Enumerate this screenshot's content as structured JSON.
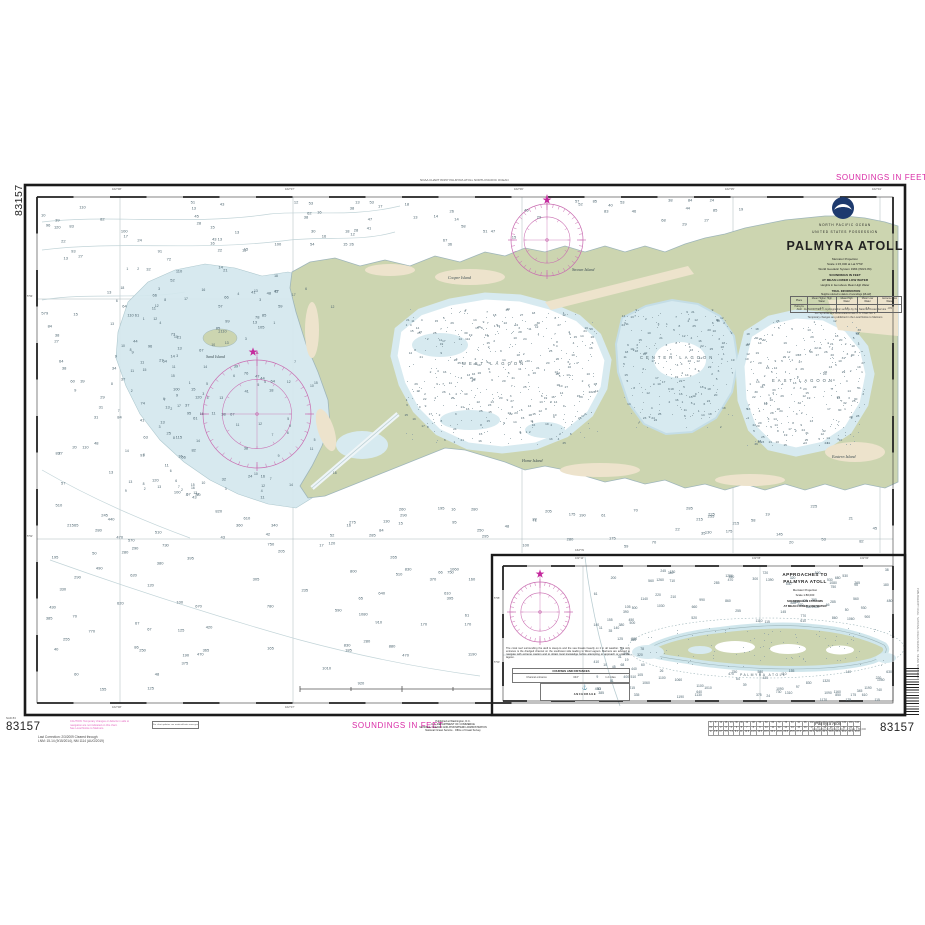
{
  "chart": {
    "number": "83157",
    "soundings_top": "SOUNDINGS IN FEET",
    "soundings_bottom": "SOUNDINGS IN FEET",
    "top_margin_note": "NOAA CHART 83157  PALMYRA ATOLL  NORTH PACIFIC OCEAN",
    "side_print_note": "PUBLISHED BY NOAA · NATIONAL OCEAN SERVICE · SILVER SPRING MD"
  },
  "title_block": {
    "region": "NORTH PACIFIC OCEAN",
    "possession": "UNITED STATES POSSESSION",
    "title": "PALMYRA ATOLL",
    "projection": "Mercator Projection",
    "scale_line": "Scale 1:15,000 at Lat 5°53'",
    "datum_line": "World Geodetic System 1984 (WGS 84)",
    "soundings1": "SOUNDINGS IN FEET",
    "soundings2": "AT MEAN LOWER LOW WATER",
    "heights_line": "Heights in feet above Mean High Water",
    "auth1": "AUTHORITIES — Hydrographic surveys by the National Ocean Service",
    "auth2": "For Symbols and Abbreviations see U.S. Chart No. 1",
    "auth3": "Temporary changes are published in the Local Notice to Mariners"
  },
  "tidal_table": {
    "title": "TIDAL INFORMATION",
    "subtitle": "Heights referred to datum of soundings (MLLW)",
    "columns": [
      "Place",
      "Mean Higher High Water",
      "Mean High Water",
      "Mean Low Water",
      "Extreme Low Water"
    ],
    "row": [
      "Palmyra Atoll",
      "1.6",
      "1.4",
      "0.3",
      "-0.5"
    ]
  },
  "labels": {
    "west_lagoon": "WEST LAGOON",
    "center_lagoon": "CENTER LAGOON",
    "east_lagoon": "EAST LAGOON",
    "islands": [
      {
        "name": "Sand Island"
      },
      {
        "name": "Cooper Island"
      },
      {
        "name": "Strawn Island"
      },
      {
        "name": "Home Island"
      },
      {
        "name": "Eastern Island"
      }
    ]
  },
  "graticule": {
    "main_top": [
      "162°08'",
      "162°07'",
      "162°06'",
      "162°05'",
      "162°04'"
    ],
    "main_bottom": [
      "162°08'",
      "162°07'"
    ],
    "main_left": [
      "5°54'",
      "5°52'"
    ],
    "inset_top": [
      "162°10'",
      "162°05'",
      "162°00'"
    ],
    "inset_left": [
      "5°55'",
      "5°50'"
    ],
    "inset_top_outer": "162°W"
  },
  "inset": {
    "title1": "APPROACHES TO",
    "title2": "PALMYRA ATOLL",
    "projection": "Mercator Projection",
    "scale": "Scale 1:80,000",
    "soundings1": "SOUNDINGS IN FATHOMS",
    "soundings2": "AT MEAN LOWER LOW WATER",
    "atoll_label": "PALMYRA ATOLL",
    "note_lines": [
      "The coral reef surrounding the atoll is steep-to and the",
      "sea breaks heavily on it in all weather. The only entrance",
      "is the dredged channel on the southwest side leading to",
      "West Lagoon. Mariners are advised to navigate with",
      "extreme caution and to obtain local knowledge before",
      "attempting to approach or enter the lagoon."
    ],
    "table_header": "COURSES AND DISTANCES",
    "table_cells": [
      "Channel entrance",
      "044°",
      "1.2 miles"
    ],
    "diagram_label": "ANCHORAGE",
    "anchor_glyph": "⚓"
  },
  "footer": {
    "number_left": "83157",
    "number_right": "83157",
    "nad_note": "NAD 83",
    "correction1": "Last Correction: 2/3/2009   Cleared through",
    "correction2": "LNM: 15-14 (9/15/2014), NM 1114 (AUG/2019)",
    "caution1": "CAUTION: Temporary changes or defects in aids to",
    "caution2": "navigation are not indicated on this chart.",
    "caution3": "See Local Notice to Mariners.",
    "box_note": "For chart updates see nauticalcharts.noaa.gov",
    "publisher1": "Published at Washington, D.C.",
    "publisher2": "U.S. DEPARTMENT OF COMMERCE",
    "publisher3": "NATIONAL OCEANIC AND ATMOSPHERIC ADMINISTRATION",
    "publisher4": "National Ocean Service · Office of Coast Survey",
    "inset_ref_title": "Palmyra Atoll",
    "inset_ref_sub": "Approaches to Palmyra Atoll — Scale 1:80,000"
  },
  "depth_conversion": {
    "row_labels": [
      "ft",
      "fm",
      "m"
    ],
    "feet": [
      6,
      12,
      18,
      24,
      30,
      36,
      42,
      48,
      54,
      60,
      66,
      72,
      78,
      84,
      90,
      96,
      102,
      108,
      114,
      120,
      126,
      132,
      138,
      144
    ],
    "fathoms": [
      1,
      2,
      3,
      4,
      5,
      6,
      7,
      8,
      9,
      10,
      11,
      12,
      13,
      14,
      15,
      16,
      17,
      18,
      19,
      20,
      21,
      22,
      23,
      24
    ],
    "meters": [
      1.8,
      3.7,
      5.5,
      7.3,
      9.1,
      11,
      12.8,
      14.6,
      16.5,
      18.3,
      20.1,
      21.9,
      23.8,
      25.6,
      27.4,
      29.3,
      31.1,
      32.9,
      34.7,
      36.6,
      38.4,
      40.2,
      42.1,
      43.9
    ]
  },
  "colors": {
    "magenta_text": "#d92ba6",
    "compass": "#c96bb0",
    "star": "#c4299d",
    "land_green": "#ccd5b0",
    "sand_tan": "#ede3cc",
    "shallow_blue": "#d4e8ee",
    "neatline": "#1a1a1a"
  },
  "compass_roses": [
    {
      "cx": 547,
      "cy": 240,
      "r": 36
    },
    {
      "cx": 257,
      "cy": 414,
      "r": 54
    },
    {
      "cx": 540,
      "cy": 612,
      "r": 30
    }
  ],
  "stars": [
    {
      "x": 547,
      "y": 200
    },
    {
      "x": 253,
      "y": 352
    },
    {
      "x": 540,
      "y": 574
    }
  ],
  "ticks": {
    "main": {
      "x0": 37,
      "y0": 197,
      "x1": 893,
      "y1": 703,
      "step": 36.5
    },
    "inset": {
      "x0": 503,
      "y0": 566,
      "x1": 893,
      "y1": 701,
      "step": 24
    }
  },
  "soundings_spec": {
    "regions": [
      {
        "seed": 11,
        "x": 42,
        "y": 202,
        "w": 240,
        "h": 300,
        "count": 130,
        "min": 9,
        "max": 120,
        "fs": 4
      },
      {
        "seed": 12,
        "x": 42,
        "y": 505,
        "w": 240,
        "h": 190,
        "count": 55,
        "min": 40,
        "max": 900,
        "fs": 4
      },
      {
        "seed": 13,
        "x": 285,
        "y": 200,
        "w": 230,
        "h": 48,
        "count": 30,
        "min": 12,
        "max": 70,
        "fs": 4
      },
      {
        "seed": 14,
        "x": 522,
        "y": 200,
        "w": 250,
        "h": 26,
        "count": 18,
        "min": 18,
        "max": 90,
        "fs": 4
      },
      {
        "seed": 15,
        "x": 320,
        "y": 505,
        "w": 565,
        "h": 42,
        "count": 48,
        "min": 15,
        "max": 300,
        "fs": 4
      },
      {
        "seed": 16,
        "x": 285,
        "y": 548,
        "w": 195,
        "h": 148,
        "count": 28,
        "min": 60,
        "max": 1200,
        "fs": 4
      },
      {
        "seed": 21,
        "x": 406,
        "y": 308,
        "w": 192,
        "h": 136,
        "count": 230,
        "min": 1,
        "max": 30,
        "fs": 3.1
      },
      {
        "seed": 22,
        "x": 623,
        "y": 310,
        "w": 110,
        "h": 118,
        "count": 120,
        "min": 1,
        "max": 26,
        "fs": 3.1
      },
      {
        "seed": 23,
        "x": 746,
        "y": 320,
        "w": 118,
        "h": 126,
        "count": 165,
        "min": 1,
        "max": 33,
        "fs": 3.1
      },
      {
        "seed": 24,
        "x": 112,
        "y": 268,
        "w": 225,
        "h": 235,
        "count": 90,
        "min": 1,
        "max": 18,
        "fs": 3.4
      },
      {
        "seed": 31,
        "x": 594,
        "y": 572,
        "w": 48,
        "h": 126,
        "count": 26,
        "min": 8,
        "max": 600,
        "fs": 3.4
      },
      {
        "seed": 32,
        "x": 642,
        "y": 570,
        "w": 248,
        "h": 52,
        "count": 55,
        "min": 25,
        "max": 1600,
        "fs": 3.4
      },
      {
        "seed": 33,
        "x": 642,
        "y": 670,
        "w": 248,
        "h": 30,
        "count": 40,
        "min": 20,
        "max": 1400,
        "fs": 3.4
      },
      {
        "seed": 34,
        "x": 600,
        "y": 622,
        "w": 44,
        "h": 46,
        "count": 12,
        "min": 10,
        "max": 200,
        "fs": 3.4
      }
    ],
    "dots": [
      {
        "seed": 41,
        "x": 406,
        "y": 308,
        "w": 192,
        "h": 136,
        "count": 260
      },
      {
        "seed": 42,
        "x": 623,
        "y": 310,
        "w": 110,
        "h": 118,
        "count": 130
      },
      {
        "seed": 43,
        "x": 746,
        "y": 320,
        "w": 118,
        "h": 126,
        "count": 170
      },
      {
        "seed": 44,
        "x": 640,
        "y": 628,
        "w": 250,
        "h": 38,
        "count": 90
      }
    ]
  }
}
